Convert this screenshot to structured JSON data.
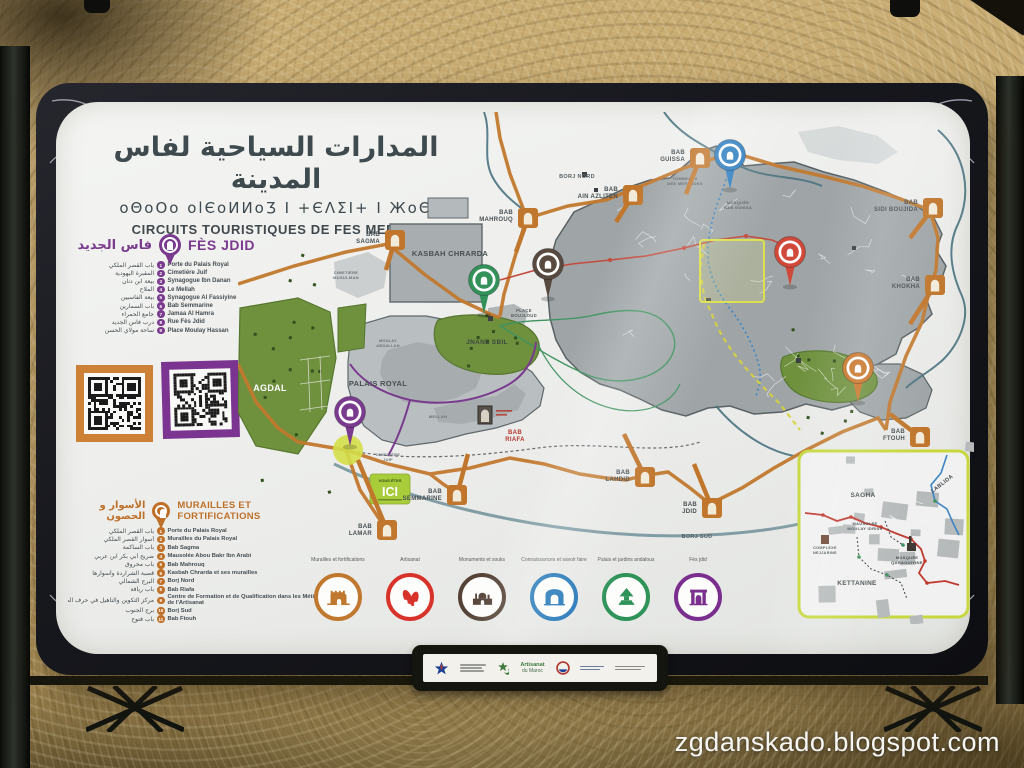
{
  "photo": {
    "watermark": "zgdanskado.blogspot.com"
  },
  "sign": {
    "title": {
      "ar": "المدارات السياحية لفاس المدينة",
      "tifinagh": "oΘoOo olЄoИИoƷ Ι +ЄΛΣΙ+ Ι ЖoΘ",
      "fr": "CIRCUITS TOURISTIQUES DE FES MEDINA"
    },
    "fes_jdid": {
      "title": "FÈS JDID",
      "title_ar": "فاس الجديد",
      "color": "#7a3b8f",
      "items": [
        {
          "n": "1",
          "fr": "Porte du Palais Royal",
          "ar": "باب القصر الملكي"
        },
        {
          "n": "2",
          "fr": "Cimetière Juif",
          "ar": "المقبرة اليهودية"
        },
        {
          "n": "3",
          "fr": "Synagogue Ibn Danan",
          "ar": "بيعة ابن دنان"
        },
        {
          "n": "4",
          "fr": "Le Mellah",
          "ar": "الملاح"
        },
        {
          "n": "5",
          "fr": "Synagogue Al Fassiyine",
          "ar": "بيعة الفاسيين"
        },
        {
          "n": "6",
          "fr": "Bab Semmarine",
          "ar": "باب السمارين"
        },
        {
          "n": "7",
          "fr": "Jamaa Al Hamra",
          "ar": "جامع الحمراء"
        },
        {
          "n": "8",
          "fr": "Rue Fès Jdid",
          "ar": "درب فاس الجديد"
        },
        {
          "n": "9",
          "fr": "Place Moulay Hassan",
          "ar": "ساحة مولاي الحسن"
        }
      ]
    },
    "murailles": {
      "title": "MURAILLES ET FORTIFICATIONS",
      "title_ar": "الأسوار و الحصون",
      "color": "#bf7028",
      "items": [
        {
          "n": "1",
          "fr": "Porte du Palais Royal",
          "ar": "باب القصر الملكي"
        },
        {
          "n": "2",
          "fr": "Murailles du Palais Royal",
          "ar": "أسوار القصر الملكي"
        },
        {
          "n": "3",
          "fr": "Bab Sagma",
          "ar": "باب الساكمة"
        },
        {
          "n": "4",
          "fr": "Mausolée Abou Bakr Ibn Arabi",
          "ar": "ضريح أبي بكر ابن عربي"
        },
        {
          "n": "5",
          "fr": "Bab Mahrouq",
          "ar": "باب محروق"
        },
        {
          "n": "6",
          "fr": "Kasbah Chrarda et ses murailles",
          "ar": "قصبة الشراردة وأسوارها"
        },
        {
          "n": "7",
          "fr": "Borj Nord",
          "ar": "البرج الشمالي"
        },
        {
          "n": "8",
          "fr": "Bab Riafa",
          "ar": "باب ريافة"
        },
        {
          "n": "9",
          "fr": "Centre de Formation et de Qualification dans les Métiers de l'Artisanat",
          "ar": "مركز التكوين والتأهيل في حرف الصناعة التقليدية بفاس"
        },
        {
          "n": "10",
          "fr": "Borj Sud",
          "ar": "برج الجنوب"
        },
        {
          "n": "11",
          "fr": "Bab Ftouh",
          "ar": "باب فتوح"
        }
      ]
    },
    "legend": {
      "items": [
        {
          "label": "Murailles et fortifications",
          "color": "#c0772e",
          "icon": "fortress"
        },
        {
          "label": "Artisanat",
          "color": "#d8332a",
          "icon": "babouches"
        },
        {
          "label": "Monuments et souks",
          "color": "#544236",
          "icon": "monuments"
        },
        {
          "label": "Connaissances et savoir faire",
          "color": "#2377b8",
          "icon": "gate"
        },
        {
          "label": "Palais et jardins andalous",
          "color": "#2f9258",
          "icon": "garden"
        },
        {
          "label": "Fès jdid",
          "color": "#7a2f8e",
          "icon": "palace"
        }
      ]
    },
    "you_are_here": {
      "top": "VOUS ÊTES",
      "main": "ICI"
    },
    "qr_colors": {
      "left": "#cd8136",
      "right": "#7b3591"
    },
    "map": {
      "labels": [
        {
          "lines": [
            "KASBAH CHRARDA"
          ],
          "x": 212,
          "y": 144,
          "size": 7.5,
          "color": "#474f52"
        },
        {
          "lines": [
            "CIMETIÈRE",
            "MUSULMAN"
          ],
          "x": 108,
          "y": 162,
          "size": 4,
          "color": "#6a7074"
        },
        {
          "lines": [
            "BORJ NORD"
          ],
          "x": 339,
          "y": 66,
          "size": 5.5,
          "color": "#5a6164"
        },
        {
          "lines": [
            "TOMBEAUX",
            "DES MERINIDES"
          ],
          "x": 447,
          "y": 68,
          "size": 4,
          "color": "#5a6164"
        },
        {
          "lines": [
            "MOSQUÉE",
            "BAB GUISSA"
          ],
          "x": 500,
          "y": 92,
          "size": 4,
          "color": "#5a6164"
        },
        {
          "lines": [
            "PLACE",
            "BOUJLOUD"
          ],
          "x": 286,
          "y": 200,
          "size": 4.2,
          "color": "#565c5f"
        },
        {
          "lines": [
            "JNANE SBIL"
          ],
          "x": 249,
          "y": 232,
          "size": 6.5,
          "color": "#3c4a40"
        },
        {
          "lines": [
            "AGDAL"
          ],
          "x": 32,
          "y": 279,
          "size": 9,
          "color": "#ffffff"
        },
        {
          "lines": [
            "PALAIS ROYAL"
          ],
          "x": 140,
          "y": 274,
          "size": 7.5,
          "color": "#474f52"
        },
        {
          "lines": [
            "MOULAY",
            "ABDALLAH"
          ],
          "x": 150,
          "y": 230,
          "size": 3.8,
          "color": "#6a7074"
        },
        {
          "lines": [
            "MELLAH"
          ],
          "x": 200,
          "y": 306,
          "size": 4,
          "color": "#6a7074"
        },
        {
          "lines": [
            "CIMETIÈRE",
            "JUIF"
          ],
          "x": 150,
          "y": 344,
          "size": 4,
          "color": "#6a7074"
        },
        {
          "lines": [
            "BORJ SUD"
          ],
          "x": 459,
          "y": 426,
          "size": 5.5,
          "color": "#5a6164"
        }
      ],
      "bab_markers": [
        {
          "lines": [
            "BAB",
            "SAGMA"
          ],
          "icon": [
            157,
            128
          ],
          "tip": [
            148,
            158
          ],
          "lx": 142,
          "ly": 124
        },
        {
          "lines": [
            "BAB",
            "MAHROUQ"
          ],
          "icon": [
            290,
            106
          ],
          "tip": [
            278,
            140
          ],
          "lx": 275,
          "ly": 102
        },
        {
          "lines": [
            "BAB",
            "GUISSA"
          ],
          "icon": [
            462,
            46
          ],
          "tip": [
            448,
            82
          ],
          "lx": 447,
          "ly": 42
        },
        {
          "lines": [
            "BAB",
            "AIN AZLITEN"
          ],
          "icon": [
            395,
            83
          ],
          "tip": [
            378,
            110
          ],
          "lx": 380,
          "ly": 79
        },
        {
          "lines": [
            "BAB",
            "SIDI BOUJIDA"
          ],
          "icon": [
            695,
            96
          ],
          "tip": [
            672,
            126
          ],
          "lx": 680,
          "ly": 92
        },
        {
          "lines": [
            "BAB",
            "KHOKHA"
          ],
          "icon": [
            697,
            173
          ],
          "tip": [
            672,
            212
          ],
          "lx": 682,
          "ly": 169
        },
        {
          "lines": [
            "BAB",
            "FTOUH"
          ],
          "icon": [
            682,
            325
          ],
          "tip": [
            652,
            302
          ],
          "lx": 667,
          "ly": 321
        },
        {
          "lines": [
            "BAB",
            "JDID"
          ],
          "icon": [
            474,
            396
          ],
          "tip": [
            456,
            352
          ],
          "lx": 459,
          "ly": 394
        },
        {
          "lines": [
            "BAB",
            "LAHDID"
          ],
          "icon": [
            407,
            365
          ],
          "tip": [
            386,
            322
          ],
          "lx": 392,
          "ly": 362
        },
        {
          "lines": [
            "BAB",
            "SEMMARINE"
          ],
          "icon": [
            219,
            383
          ],
          "tip": [
            230,
            342
          ],
          "lx": 204,
          "ly": 381
        },
        {
          "lines": [
            "BAB",
            "LAMAR"
          ],
          "icon": [
            149,
            418
          ],
          "tip": [
            120,
            348
          ],
          "lx": 134,
          "ly": 416
        },
        {
          "lines": [
            "BAB",
            "RIAFA"
          ],
          "icon": null,
          "lx": 277,
          "ly": 322,
          "anchor": "middle",
          "color": "#b5342c"
        }
      ],
      "pins": [
        {
          "name": "fes-jdid-pin",
          "x": 112,
          "y": 300,
          "color": "#7a3b8f"
        },
        {
          "name": "palais-jardins-pin",
          "x": 246,
          "y": 168,
          "color": "#33915a"
        },
        {
          "name": "monuments-souks-pin",
          "x": 310,
          "y": 152,
          "color": "#584a3e"
        },
        {
          "name": "connaissances-pin",
          "x": 492,
          "y": 43,
          "color": "#2f7fc1"
        },
        {
          "name": "artisanat-pin",
          "x": 552,
          "y": 140,
          "color": "#d04a3c"
        },
        {
          "name": "murailles-pin",
          "x": 620,
          "y": 256,
          "color": "#c9762b"
        }
      ],
      "inset": {
        "labels": [
          {
            "lines": [
              "SAGHA"
            ],
            "x": 64,
            "y": 46,
            "size": 6.5,
            "color": "#474f52"
          },
          {
            "lines": [
              "LABLIDA"
            ],
            "x": 144,
            "y": 34,
            "size": 5.5,
            "rotate": -38,
            "color": "#474f52"
          },
          {
            "lines": [
              "MAUSOLÉE",
              "MOULAY IDRISS"
            ],
            "x": 66,
            "y": 74,
            "size": 4,
            "color": "#474f52"
          },
          {
            "lines": [
              "COMPLEXE",
              "NEJJARINE"
            ],
            "x": 26,
            "y": 98,
            "size": 3.8,
            "color": "#474f52"
          },
          {
            "lines": [
              "MOSQUÉE",
              "QARAOUIYINE"
            ],
            "x": 108,
            "y": 108,
            "size": 4,
            "color": "#474f52"
          },
          {
            "lines": [
              "KETTANINE"
            ],
            "x": 58,
            "y": 134,
            "size": 6.5,
            "color": "#474f52"
          }
        ]
      }
    },
    "plaque": {
      "artisanat_top": "Artisanat",
      "artisanat_bottom": "du Maroc"
    }
  }
}
